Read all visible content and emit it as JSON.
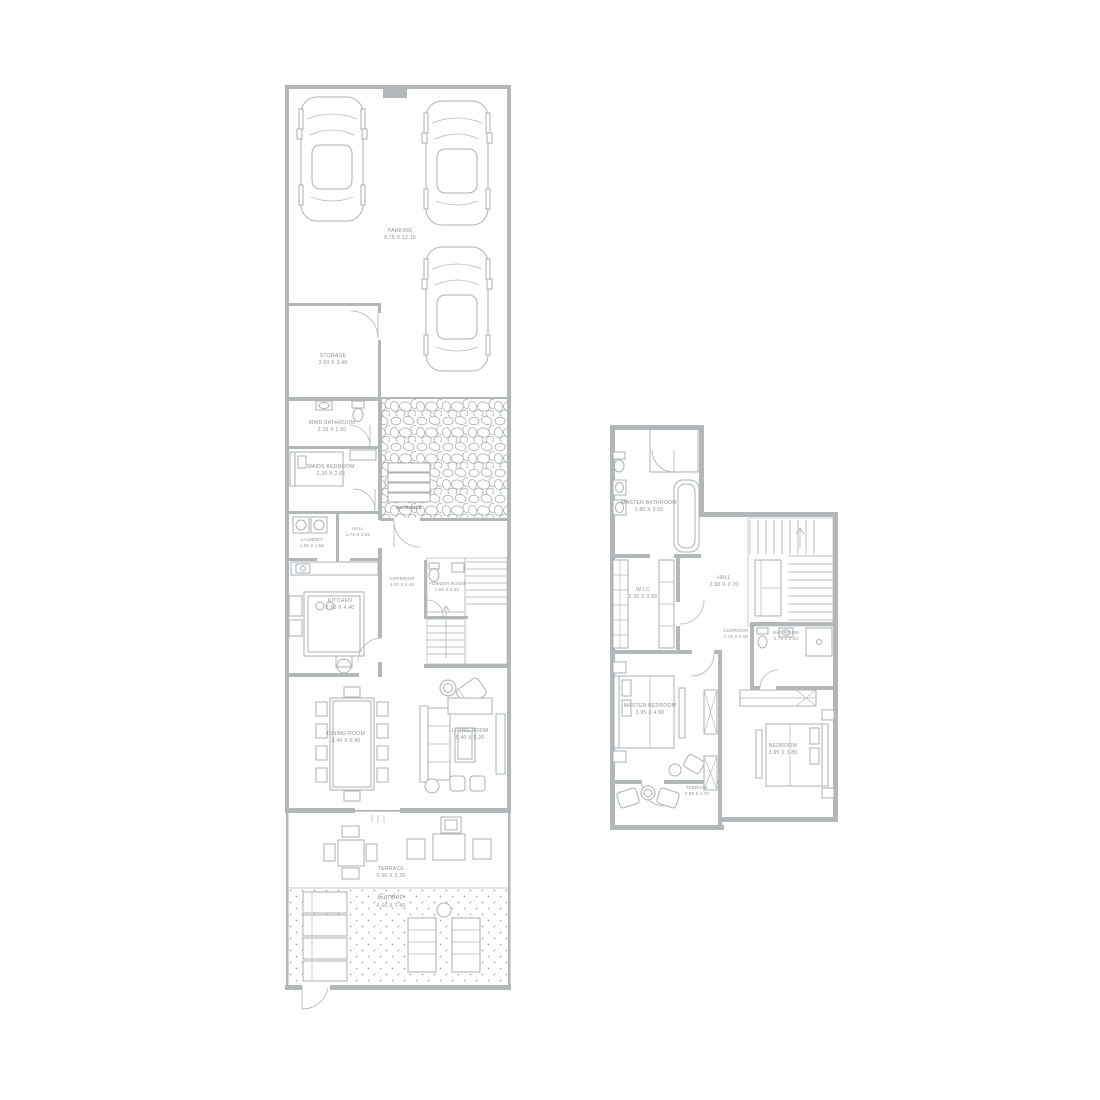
{
  "palette": {
    "wall": "#b2b7ba",
    "line": "#aab0b4",
    "text": "#8e9498",
    "background": "#ffffff"
  },
  "ground_floor": {
    "rooms": [
      {
        "id": "parking",
        "name": "PARKING",
        "dim": "8.75 X 12.15"
      },
      {
        "id": "storage",
        "name": "STORAGE",
        "dim": "3.50 X 3.40"
      },
      {
        "id": "maid-bathroom",
        "name": "MAID BATHROOM",
        "dim": "2.15 X 1.60"
      },
      {
        "id": "maids-bedroom",
        "name": "MAIDS BEDROOM",
        "dim": "2.20 X 2.65"
      },
      {
        "id": "laundry",
        "name": "LAUNDRY",
        "dim": "1.60 X 1.50"
      },
      {
        "id": "hall",
        "name": "HALL",
        "dim": "1.75 X 3.05"
      },
      {
        "id": "kitchen",
        "name": "KITCHEN",
        "dim": "2.30 X 4.40"
      },
      {
        "id": "corridor",
        "name": "CORRIDOR",
        "dim": "4.00 X 1.40"
      },
      {
        "id": "powder-room",
        "name": "POWDER ROOM",
        "dim": "1.60 X 2.30"
      },
      {
        "id": "dining-room",
        "name": "DINING ROOM",
        "dim": "3.40 X 5.40"
      },
      {
        "id": "living-room",
        "name": "LIVING ROOM",
        "dim": "5.40 X 5.20"
      },
      {
        "id": "terrace",
        "name": "TERRACE",
        "dim": "6.60 X 3.20"
      },
      {
        "id": "garden",
        "name": "Garden",
        "dim": "6.60 X 2.40"
      }
    ],
    "entrance_label": "ENTRANCE"
  },
  "first_floor": {
    "rooms": [
      {
        "id": "master-bathroom",
        "name": "MASTER BATHROOM",
        "dim": "1.80 X 3.60"
      },
      {
        "id": "wic",
        "name": "W.I.C",
        "dim": "2.50 X 3.65"
      },
      {
        "id": "hall",
        "name": "HALL",
        "dim": "2.90 X 2.70"
      },
      {
        "id": "master-bedroom",
        "name": "MASTER BEDROOM",
        "dim": "3.95 X 4.90"
      },
      {
        "id": "corridor",
        "name": "CORRIDOR",
        "dim": "1.15 X 2.55"
      },
      {
        "id": "bathroom",
        "name": "BATHROOM",
        "dim": "2.75 X 2.20"
      },
      {
        "id": "bedroom",
        "name": "BEDROOM",
        "dim": "3.65 X 3.85"
      },
      {
        "id": "terrace",
        "name": "TERRACE",
        "dim": "2.95 X 1.70"
      }
    ]
  }
}
